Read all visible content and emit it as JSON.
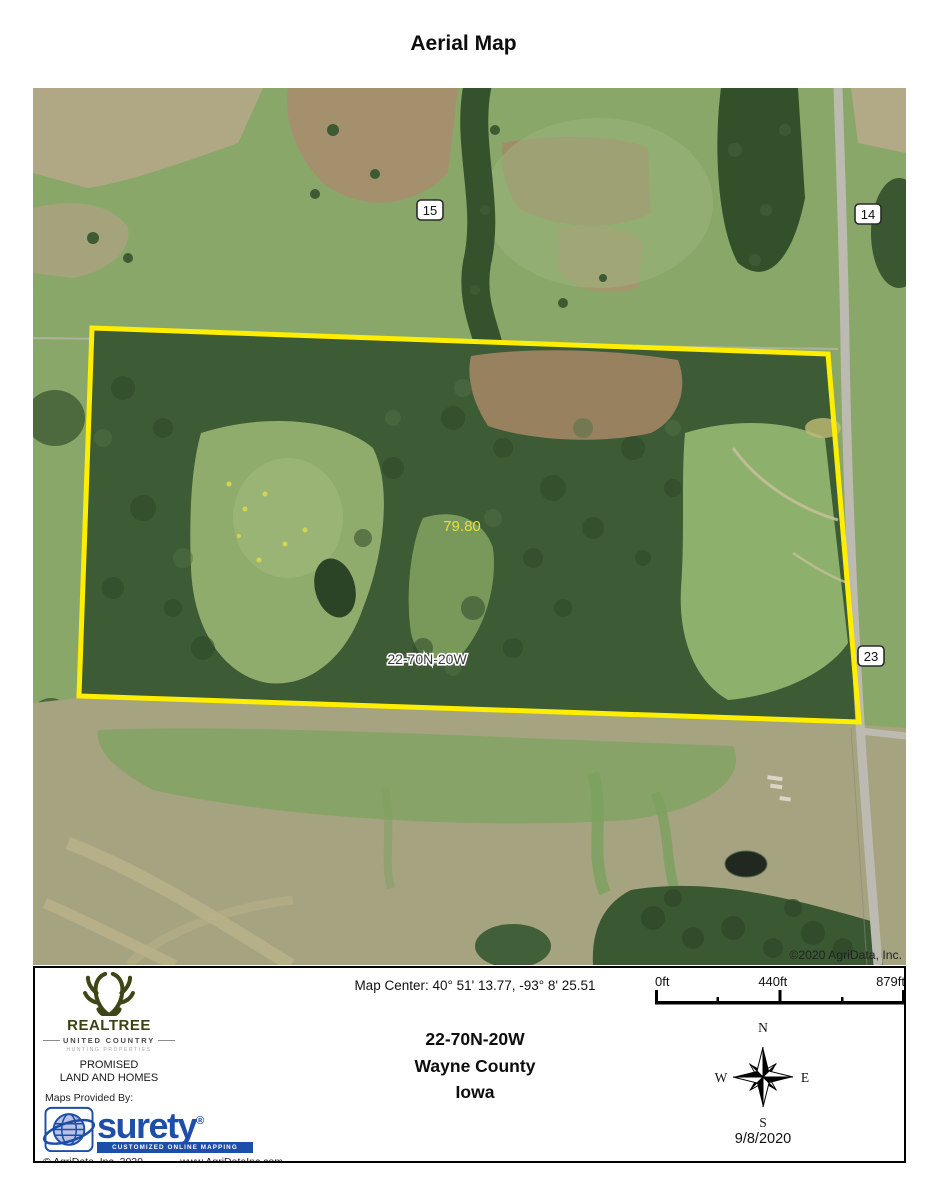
{
  "page": {
    "title": "Aerial Map"
  },
  "map": {
    "copyright": "©2020 AgriData, Inc.",
    "acreage": "79.80",
    "trs_label": "22-70N-20W",
    "sections": {
      "s15": "15",
      "s14": "14",
      "s23": "23"
    },
    "boundary_color": "#ffee00",
    "acreage_color": "#e8df3c"
  },
  "footer": {
    "map_center": "Map Center: 40° 51' 13.77,  -93° 8' 25.51",
    "scale": {
      "start": "0ft",
      "mid": "440ft",
      "end": "879ft"
    },
    "location": {
      "trs": "22-70N-20W",
      "county": "Wayne County",
      "state": "Iowa"
    },
    "compass": {
      "n": "N",
      "e": "E",
      "s": "S",
      "w": "W"
    },
    "date": "9/8/2020",
    "branding": {
      "realtree": "REALTREE",
      "united_country": "UNITED COUNTRY",
      "hunting_properties": "HUNTING PROPERTIES",
      "promised_line1": "PROMISED",
      "promised_line2": "LAND AND HOMES",
      "maps_provided_by": "Maps Provided By:",
      "surety": "surety",
      "surety_reg": "®",
      "surety_tagline": "CUSTOMIZED ONLINE MAPPING",
      "surety_blue": "#1d4ea8",
      "realtree_olive": "#3e4516",
      "agridata_copyright": "© AgriData, Inc. 2020",
      "website": "www.AgriDataInc.com"
    }
  }
}
